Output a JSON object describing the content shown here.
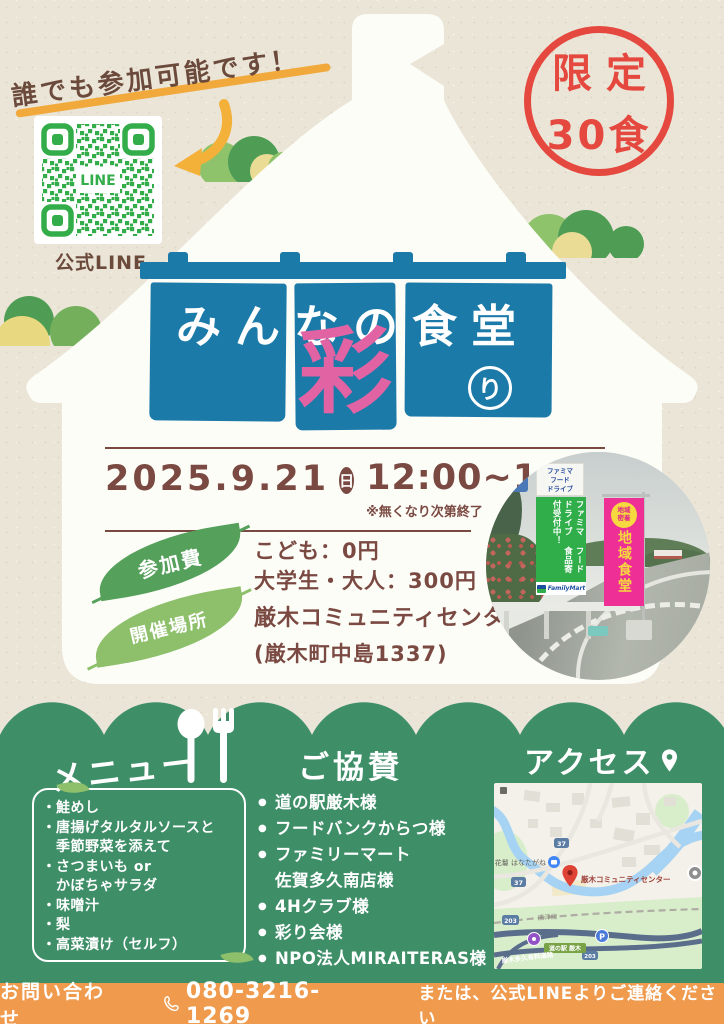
{
  "colors": {
    "paper": "#EAE5D7",
    "noren_blue": "#1C7AA9",
    "accent_pink": "#E263A3",
    "stamp_red": "#E5483E",
    "text_brown": "#7A4A42",
    "highlight_orange": "#F2A93B",
    "leaf_green": "#55A05A",
    "leaf_light_green": "#8EC06C",
    "section_green": "#3E8E68",
    "footer_orange": "#EF9A4D",
    "qr_green": "#33AD4A"
  },
  "top": {
    "tagline": "誰でも参加可能です！",
    "qr_center_label": "LINE",
    "qr_caption": "公式LINE",
    "stamp_line1": "限定",
    "stamp_line2": "30食"
  },
  "title": {
    "main": "みんなの食堂",
    "accent": "彩",
    "suffix": "り"
  },
  "schedule": {
    "date": "2025.9.21",
    "weekday": "日",
    "time": "12:00~14:00",
    "note": "※無くなり次第終了"
  },
  "fee": {
    "label": "参加費",
    "line1": "こども：0円",
    "line2": "大学生・大人：300円"
  },
  "venue": {
    "label": "開催場所",
    "line1": "厳木コミュニティセンター",
    "line2": "(厳木町中島1337)"
  },
  "photo": {
    "sign_line1": "ファミマ",
    "sign_line2": "フード",
    "sign_line3": "ドライブ",
    "banner_col1": "ファミマ",
    "banner_col2": "フードドライブ",
    "banner_col3": "食品寄付受付中！",
    "brand": "FamilyMart",
    "pink_badge_line1": "地域",
    "pink_badge_line2": "密着",
    "pink_text": "地域食堂"
  },
  "menu": {
    "heading": "メニュー",
    "lines": [
      {
        "bullet": "・",
        "text": "鮭めし"
      },
      {
        "bullet": "・",
        "text": "唐揚げタルタルソースと"
      },
      {
        "bullet": "",
        "text": "季節野菜を添えて"
      },
      {
        "bullet": "・",
        "text": "さつまいも or"
      },
      {
        "bullet": "",
        "text": "かぼちゃサラダ"
      },
      {
        "bullet": "・",
        "text": "味噌汁"
      },
      {
        "bullet": "・",
        "text": "梨"
      },
      {
        "bullet": "・",
        "text": "高菜漬け（セルフ）"
      }
    ]
  },
  "sponsors": {
    "heading": "ご協賛",
    "lines": [
      {
        "bullet": "●",
        "text": "道の駅厳木様"
      },
      {
        "bullet": "●",
        "text": "フードバンクからつ様"
      },
      {
        "bullet": "●",
        "text": "ファミリーマート"
      },
      {
        "bullet": "",
        "text": "佐賀多久南店様"
      },
      {
        "bullet": "●",
        "text": "4Hクラブ様"
      },
      {
        "bullet": "●",
        "text": "彩り会様"
      },
      {
        "bullet": "●",
        "text": "NPO法人MIRAITERAS様"
      }
    ]
  },
  "access": {
    "heading": "アクセス",
    "map": {
      "poi_lodging": "花鬘 はなたがね",
      "destination": "厳木コミュニティセンター",
      "railway": "唐津線",
      "roadside_station": "道の駅 厳木",
      "toll_road": "厳木多久有料道路",
      "route_a": "37",
      "route_b": "203",
      "parking": "P"
    }
  },
  "footer": {
    "label": "お問い合わせ",
    "phone": "080-3216-1269",
    "note": "または、公式LINEよりご連絡ください"
  }
}
